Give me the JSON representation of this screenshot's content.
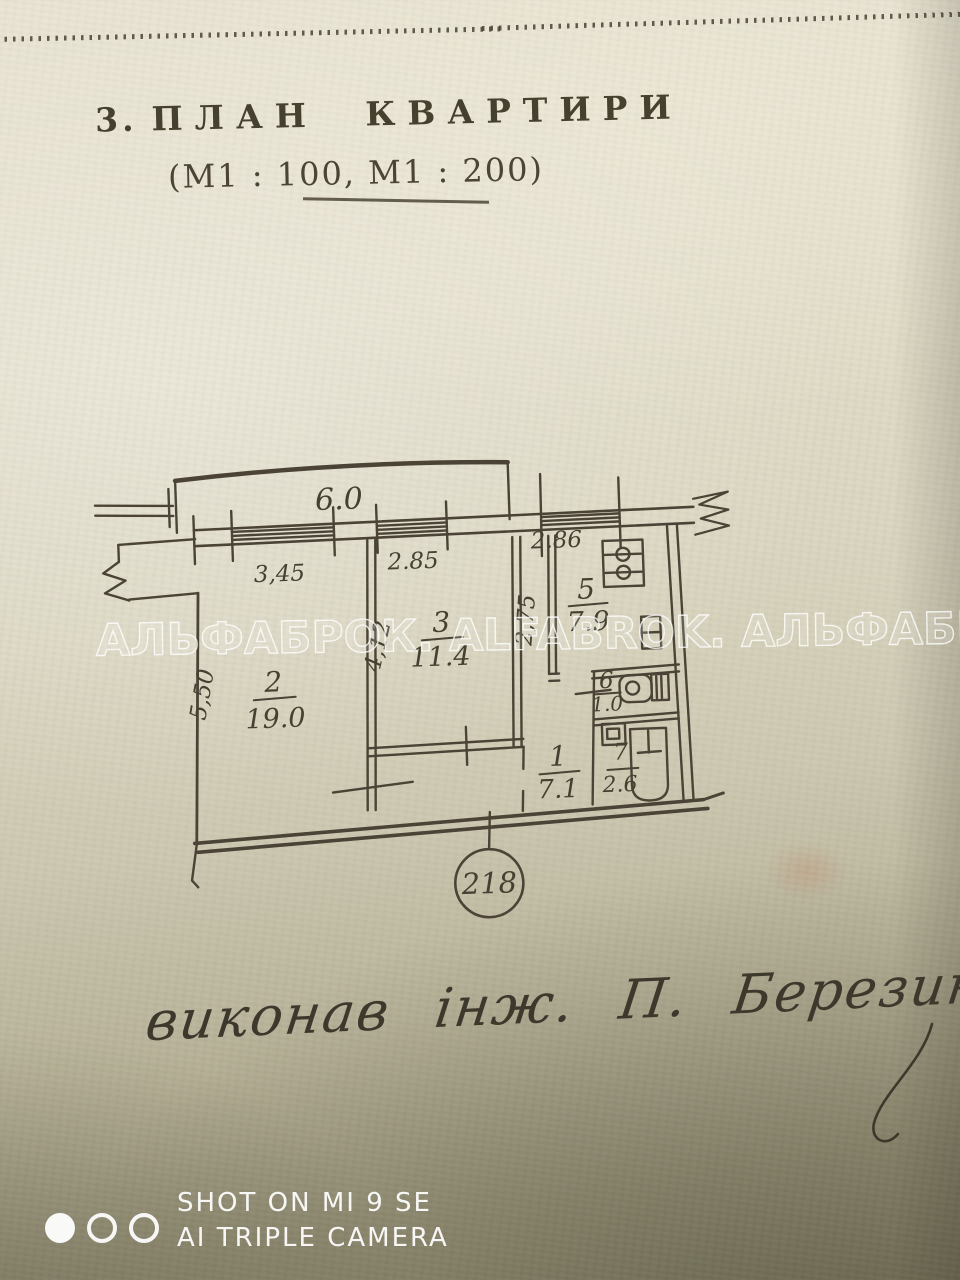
{
  "document": {
    "section_number": "3.",
    "section_title": "ПЛАН КВАРТИРИ",
    "scale_note": "(М1 : 100, М1 : 200)"
  },
  "watermark_text": "АЛЬФАБРОК. ALFABROK. АЛЬФАБРОК",
  "plan": {
    "balcony_length": "6.0",
    "dimensions": {
      "window_left": "3,45",
      "window_mid": "2.85",
      "kitchen_width": "2.86",
      "kitchen_depth": "2,75",
      "room3_depth": "4,12",
      "room2_depth": "5,50"
    },
    "rooms": [
      {
        "number": "2",
        "area": "19.0"
      },
      {
        "number": "3",
        "area": "11.4"
      },
      {
        "number": "5",
        "area": "7.9"
      },
      {
        "number": "1",
        "area": "7.1"
      },
      {
        "number": "6",
        "area": "1.0"
      },
      {
        "number": "7",
        "area": "2.6"
      }
    ],
    "apartment_number": "218"
  },
  "signature_text": "виконав інж. П. Березин",
  "camera_watermark": {
    "line1": "SHOT ON MI 9 SE",
    "line2": "AI TRIPLE CAMERA"
  },
  "colors": {
    "ink": "#4a4336",
    "paper_light": "#e9e4d2",
    "paper_dark": "#8e8a6e",
    "watermark_white": "#ffffff"
  }
}
